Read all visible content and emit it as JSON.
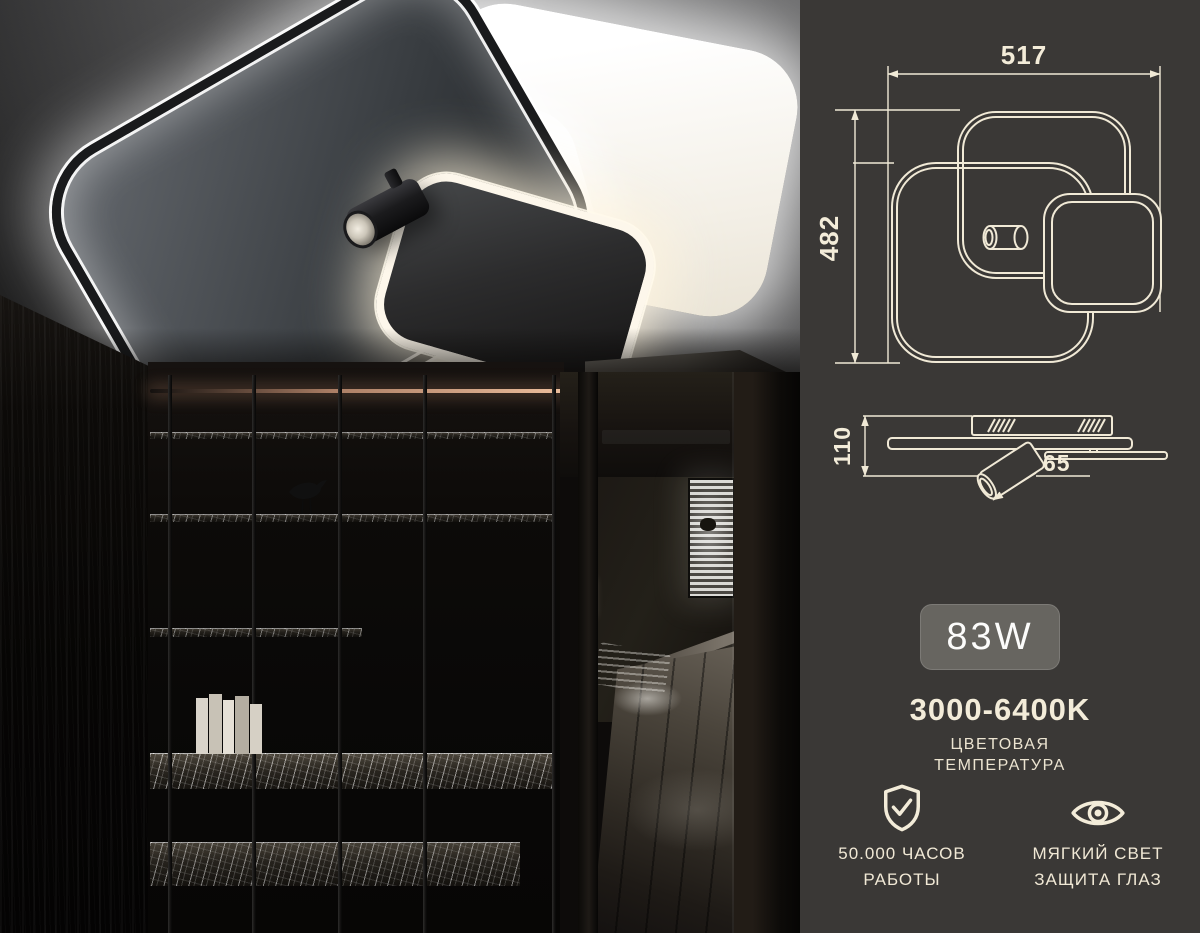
{
  "panel": {
    "top_view": {
      "width_label": "517",
      "height_label": "482"
    },
    "side_view": {
      "height_label": "110",
      "spot_length_label": "65"
    },
    "power_badge": "83W",
    "color_temperature": {
      "value": "3000-6400K",
      "caption_line1": "ЦВЕТОВАЯ",
      "caption_line2": "ТЕМПЕРАТУРА"
    },
    "features": [
      {
        "icon": "shield-check-icon",
        "caption_line1": "50.000 ЧАСОВ",
        "caption_line2": "РАБОТЫ"
      },
      {
        "icon": "eye-icon",
        "caption_line1": "МЯГКИЙ СВЕТ",
        "caption_line2": "ЗАЩИТА ГЛАЗ"
      }
    ],
    "colors": {
      "panel_bg": "#3a3836",
      "accent_cream": "#f3ecd9",
      "badge_bg": "#676560",
      "badge_text": "#fcfcfb"
    }
  }
}
